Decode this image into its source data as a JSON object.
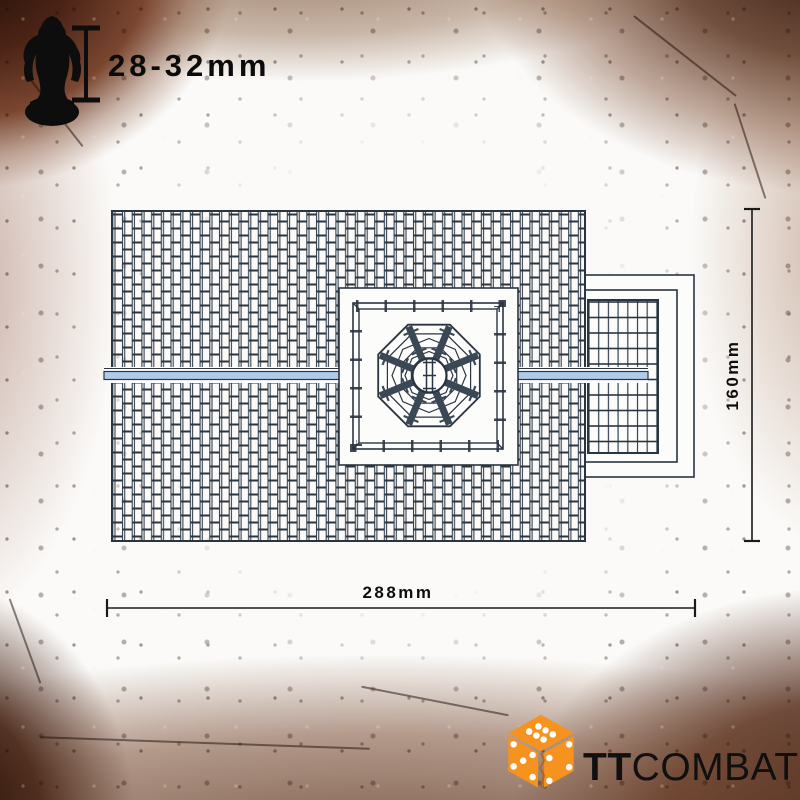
{
  "scale_indicator": {
    "label": "28-32mm",
    "figure_icon": "miniature-figure-icon",
    "bar_icon": "height-scale-bar-icon"
  },
  "dimensions": {
    "width_label": "288mm",
    "height_label": "160mm"
  },
  "drawing": {
    "subject": "roof plan top view",
    "features": [
      "tiled main roof",
      "horizontal ridge line",
      "central square platform",
      "octagonal dome skylight with eight spokes",
      "right side extension roof"
    ]
  },
  "logo": {
    "brand_bold": "TT",
    "brand_regular": "COMBAT",
    "die_icon": "cracked-orange-die-icon"
  },
  "colors": {
    "accent_orange": "#F6921E",
    "line_ink": "#2C3847",
    "ridge_highlight": "#AECBE8",
    "rust_dark": "#2A1209",
    "rust_mid": "#7A4630",
    "dimension_ink": "#1A1A1A",
    "background": "#FBFAF8"
  }
}
